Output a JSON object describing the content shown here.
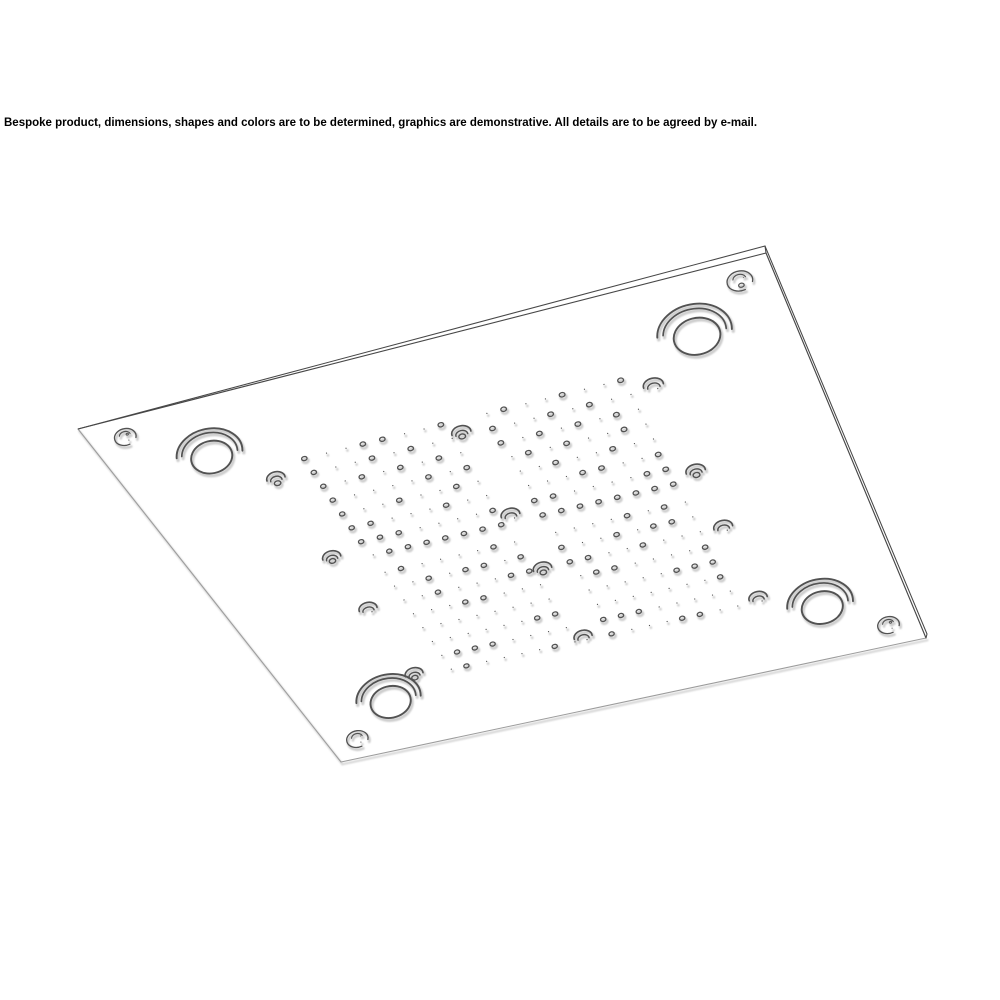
{
  "page": {
    "background_color": "#ffffff"
  },
  "disclaimer": {
    "text": "Bespoke product, dimensions, shapes and colors are to be determined, graphics are demonstrative. All details are to be agreed by e-mail."
  },
  "drawing": {
    "type": "technical_line_drawing",
    "subject": "Square multifunction ceiling shower head panel viewed from below in perspective",
    "colors": {
      "ink": "#525252",
      "edge_dark": "#474747",
      "edge_light": "#9c9c9c",
      "ghost": "#cdcdcd",
      "ghost_edge": "#d9d9d9",
      "face_fill": "#ffffff"
    },
    "panel": {
      "face_corners": {
        "left": [
          78,
          429
        ],
        "top": [
          766,
          253
        ],
        "right": [
          926,
          638
        ],
        "bottom": [
          341,
          762
        ]
      },
      "outer_rim": [
        [
          78,
          429
        ],
        [
          765,
          246
        ],
        [
          927,
          634
        ]
      ],
      "rim_connectors": [
        [
          [
            765,
            246
          ],
          [
            766,
            253
          ]
        ],
        [
          [
            927,
            634
          ],
          [
            926,
            638
          ]
        ]
      ]
    },
    "corner_screws": {
      "count": 4,
      "positions_uv": [
        [
          0.05,
          0.05
        ],
        [
          0.95,
          0.05
        ],
        [
          0.95,
          0.95
        ],
        [
          0.05,
          0.95
        ]
      ]
    },
    "led_spotlights": {
      "count": 4,
      "positions_uv": [
        [
          0.14,
          0.14
        ],
        [
          0.86,
          0.14
        ],
        [
          0.86,
          0.86
        ],
        [
          0.14,
          0.86
        ]
      ]
    },
    "mid_nozzles": {
      "count": 12,
      "positions_uv": [
        [
          0.2,
          0.25
        ],
        [
          0.48,
          0.25
        ],
        [
          0.77,
          0.25
        ],
        [
          0.2,
          0.48
        ],
        [
          0.48,
          0.48
        ],
        [
          0.77,
          0.48
        ],
        [
          0.2,
          0.63
        ],
        [
          0.48,
          0.63
        ],
        [
          0.77,
          0.63
        ],
        [
          0.2,
          0.82
        ],
        [
          0.48,
          0.82
        ],
        [
          0.77,
          0.82
        ]
      ]
    },
    "spray_grids": {
      "count": 4,
      "rows": 8,
      "cols": 8,
      "areas_uv": [
        [
          0.255,
          0.215,
          0.46,
          0.495
        ],
        [
          0.525,
          0.215,
          0.73,
          0.495
        ],
        [
          0.255,
          0.545,
          0.46,
          0.825
        ],
        [
          0.525,
          0.545,
          0.73,
          0.825
        ]
      ]
    }
  }
}
